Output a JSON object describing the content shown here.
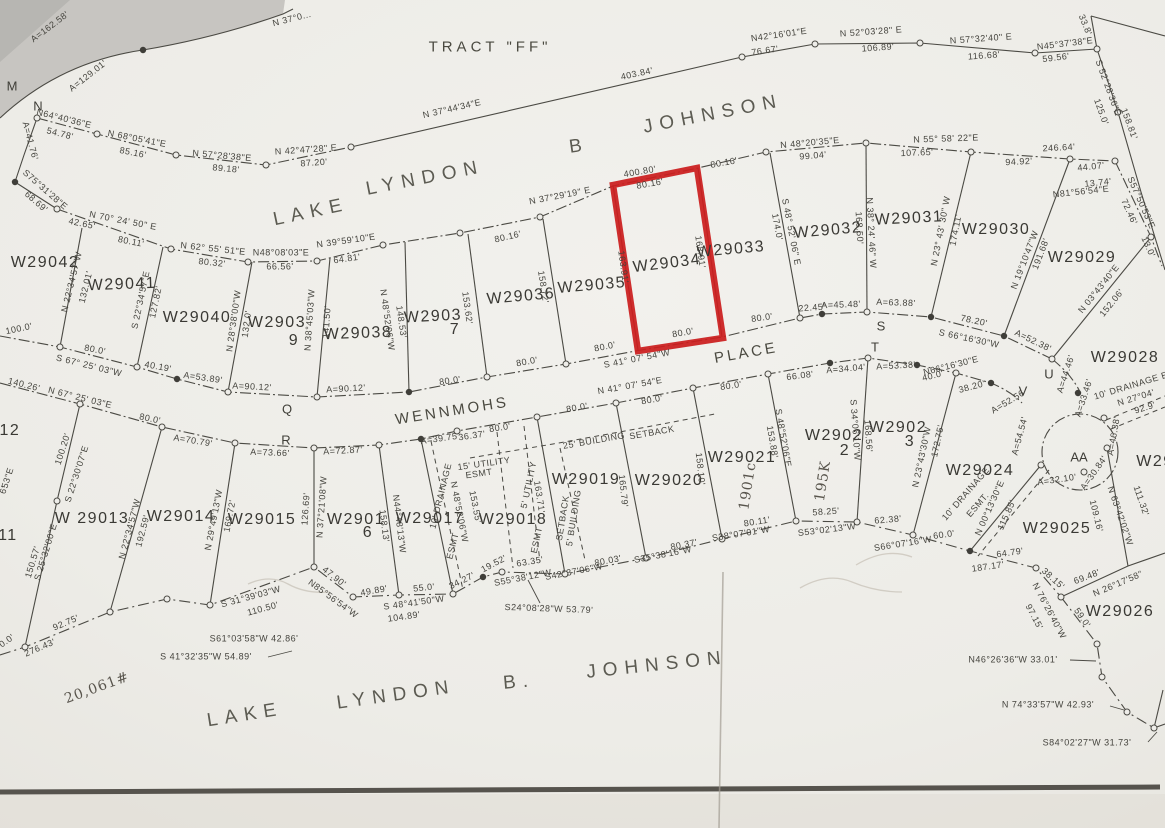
{
  "highlighted_lot": "W29034",
  "highlight_color": "#cb1e1e",
  "t": [
    "A=162.58'",
    "A=129.01'",
    "N 37°0...",
    "TRACT  \"FF\"",
    "403.84'",
    "N 37°44'34\"E",
    "N42°16'01\"E",
    "76.67'",
    "N 52°03'28\" E",
    "106.89'",
    "N 57°32'40\" E",
    "116.68'",
    "N45°37'38\"E",
    "59.56'",
    "33.8'",
    "S 52°28'36\"E",
    "158.81'",
    "125.0'",
    "S57°50'53\"E",
    "72.46'",
    "13.0'"
  ],
  "w": [
    "N64°40'36\"E",
    "54.78'",
    "N 68°05'41\"E",
    "85.16'",
    "N 57°28'38\"E",
    "89.18'",
    "N 42°47'28\" E",
    "87.20'",
    "A=41.76'",
    "S75°31'28\"E",
    "68.69'",
    "42.65'",
    "N 70° 24' 50\" E",
    "80.11'",
    "N 62° 55' 51\"E",
    "80.32'",
    "N48°08'03\"E",
    "66.56'",
    "N 39°59'10\"E",
    "64.81'",
    "80.16'",
    "N 37°29'19\" E",
    "400.80'",
    "80.16'",
    "80.16'",
    "N 48°20'35\"E",
    "99.04'",
    "N 55° 58' 22\"E",
    "107.65'",
    "246.64'",
    "94.92'",
    "44.07'",
    "13.74'",
    "N81°56'54\"E"
  ],
  "ul": [
    "W29042",
    "W29041",
    "W29040",
    "W2903",
    "9",
    "W29038",
    "W2903",
    "7",
    "W29036",
    "W29035",
    "W29034",
    "W29033",
    "W29032",
    "W29031",
    "W29030",
    "W29029",
    "W29028",
    "W29",
    "W29012",
    "W29011"
  ],
  "ud": [
    "N 22°34'57\"W",
    "132.01'",
    "S 22°34'57\"E",
    "127.82'",
    "N 28°38'00\"W",
    "132.0'",
    "N 38°45'03\"W",
    "141.50'",
    "N 48°52'06\"W",
    "148.53'",
    "153.62'",
    "158.72'",
    "163.91'",
    "168.91'",
    "S 48° 52' 06\" E",
    "174.0'",
    "N 38° 24' 46\" W",
    "168.50'",
    "N 23° 43' 30\" W",
    "174.11'",
    "N 19°10'47\"W",
    "191.68'",
    "N 03°43'40\"E",
    "152.06'"
  ],
  "st": [
    "100.0'",
    "S 67° 25' 03\"W",
    "80.0'",
    "40.19'",
    "A=53.89'",
    "A=90.12'",
    "A=90.12'",
    "80.0'",
    "80.0'",
    "80.0'",
    "S 41° 07' 54\"W",
    "80.0'",
    "80.0'",
    "22.45'",
    "A=45.48'",
    "A=63.88'",
    "78.20'",
    "S 66°16'30\"W",
    "A=52.38'",
    "140.26'",
    "N 67° 25' 03\"E",
    "80.0'",
    "A=70.79'",
    "A=73.66'",
    "A=72.87'",
    "A=39.75",
    "36.37'",
    "80.0'",
    "80.0'",
    "N 41° 07' 54\"E",
    "80.0'",
    "80.0'",
    "66.08'",
    "A=34.04'",
    "A=53.38'",
    "N66°16'30\"E",
    "40.0'",
    "38.20'",
    "A=52.56",
    "A=44.46'",
    "A=33.46'",
    "A=54.54'",
    "A=32.10'",
    "A=46.38'",
    "A=30.84'",
    "WENNMOHS",
    "PLACE"
  ],
  "pt": [
    "M",
    "N",
    "Q",
    "R",
    "S",
    "T",
    "U",
    "V",
    "AA"
  ],
  "ll": [
    "W 29013",
    "W29014",
    "W29015",
    "W2901",
    "6",
    "W29017",
    "W29018",
    "W29019",
    "W29020",
    "W29021",
    "W2902",
    "2",
    "W2902",
    "3",
    "W29024",
    "W29025",
    "W29026"
  ],
  "ld": [
    "S 22°30'07\"E",
    "100.20'",
    "S 25°32'00\"E",
    "150.57'",
    "N 22°34'57\"W",
    "192.59'",
    "N 29°49'13\"W",
    "169.72'",
    "N 37°21'08\"W",
    "126.69'",
    "N44°48'13\"W",
    "158.13'",
    "N 48°52'06\"W",
    "153.55'",
    "163.71'",
    "165.79'",
    "158.10'",
    "S 48°52'06\"E",
    "153.88'",
    "S 34°06'10\"W",
    "168.56'",
    "N 23°43'30\"W",
    "172.75'",
    "N 00°13'30\"E",
    "115.85'",
    "N 63°42'02\"W",
    "111.32'",
    "109.16'",
    "N 26°17'58\""
  ],
  "sh": [
    "0.0'",
    "276.43'",
    "92.75'",
    "S 31°39'03\"W",
    "110.50'",
    "S61°03'58\"W 42.86'",
    "S 41°32'35\"W 54.89'",
    "47.90'",
    "N85°56'54\"W",
    "49.89'",
    "S 48°41'50\"W",
    "104.89'",
    "55.0'",
    "34.27'",
    "19.52'",
    "63.35'",
    "S55°38'12\"W",
    "S42°37'06\"W",
    "80.03'",
    "S35°38'16\"W",
    "80.37'",
    "S38°07'01\"W",
    "80.11'",
    "S53°02'13\"W",
    "58.25'",
    "62.38'",
    "S66°07'16\"W",
    "60.0'",
    "64.79'",
    "187.17'",
    "38.15'",
    "69.48'",
    "N 76°26'40\"W",
    "97.15'",
    "59.0'",
    "N46°26'36\"W 33.01'",
    "N 74°33'57\"W 42.93'",
    "S84°02'27\"W 31.73'",
    "S24°08'28\"W 53.79'"
  ],
  "es": [
    "25' BUILDING",
    "SETBACK",
    "5' BUILDING",
    "SETBACK",
    "15' UTILITY",
    "ESMT",
    "5' UTILITY",
    "ESMT",
    "10' DRAINAGE",
    "ESMT",
    "10' DRAINAGE",
    "ESMT.",
    "10' DRAINAGE E",
    "N 27°04'",
    "92.9'"
  ],
  "hw": [
    "20,061#",
    "1901c",
    "195K"
  ],
  "lk": [
    "LAKE",
    "LYNDON",
    "B",
    "JOHNSON",
    "LAKE",
    "LYNDON",
    "B.",
    "JOHNSON"
  ],
  "px": [
    "53\"E",
    "6'"
  ]
}
